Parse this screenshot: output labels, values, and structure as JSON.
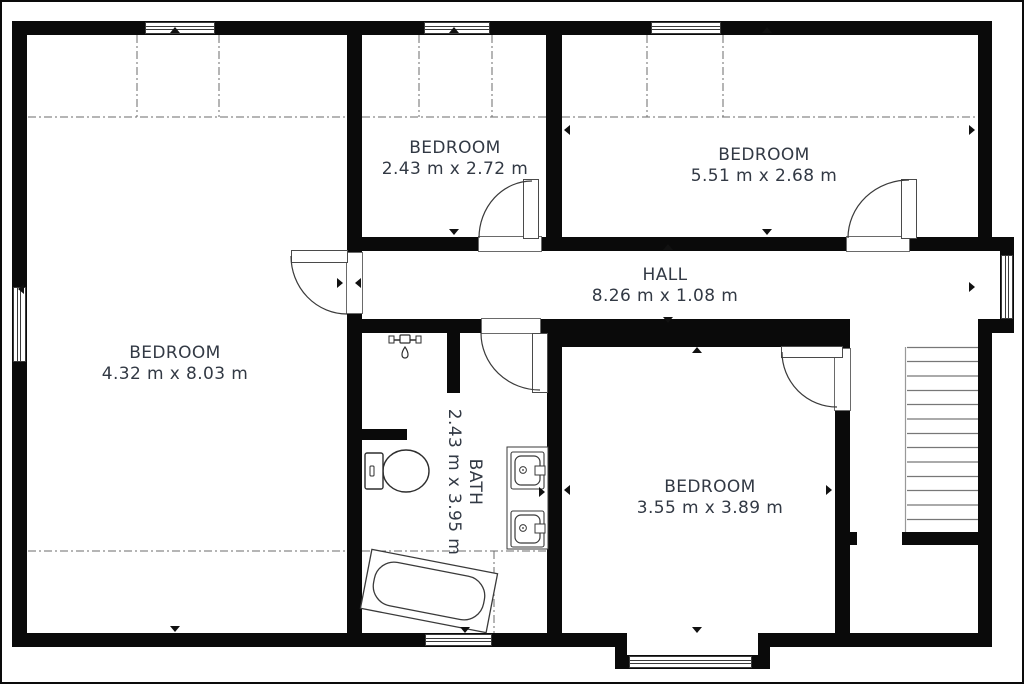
{
  "colors": {
    "wall": "#0a0a0a",
    "label_text": "#323944",
    "fixture_line": "#3a3a3a",
    "background": "#ffffff"
  },
  "floorplan": {
    "rooms": [
      {
        "id": "bedroom-left",
        "label": "BEDROOM",
        "dimensions": "4.32 m x 8.03 m"
      },
      {
        "id": "bedroom-top-middle",
        "label": "BEDROOM",
        "dimensions": "2.43 m x 2.72 m"
      },
      {
        "id": "bedroom-top-right",
        "label": "BEDROOM",
        "dimensions": "5.51 m x 2.68 m"
      },
      {
        "id": "hall",
        "label": "HALL",
        "dimensions": "8.26 m x 1.08 m"
      },
      {
        "id": "bath",
        "label": "BATH",
        "dimensions": "2.43 m x 3.95 m"
      },
      {
        "id": "bedroom-bottom-right",
        "label": "BEDROOM",
        "dimensions": "3.55 m x 3.89 m"
      }
    ],
    "fixtures": [
      "staircase",
      "bathtub",
      "toilet",
      "double-sink",
      "shower-head"
    ]
  }
}
